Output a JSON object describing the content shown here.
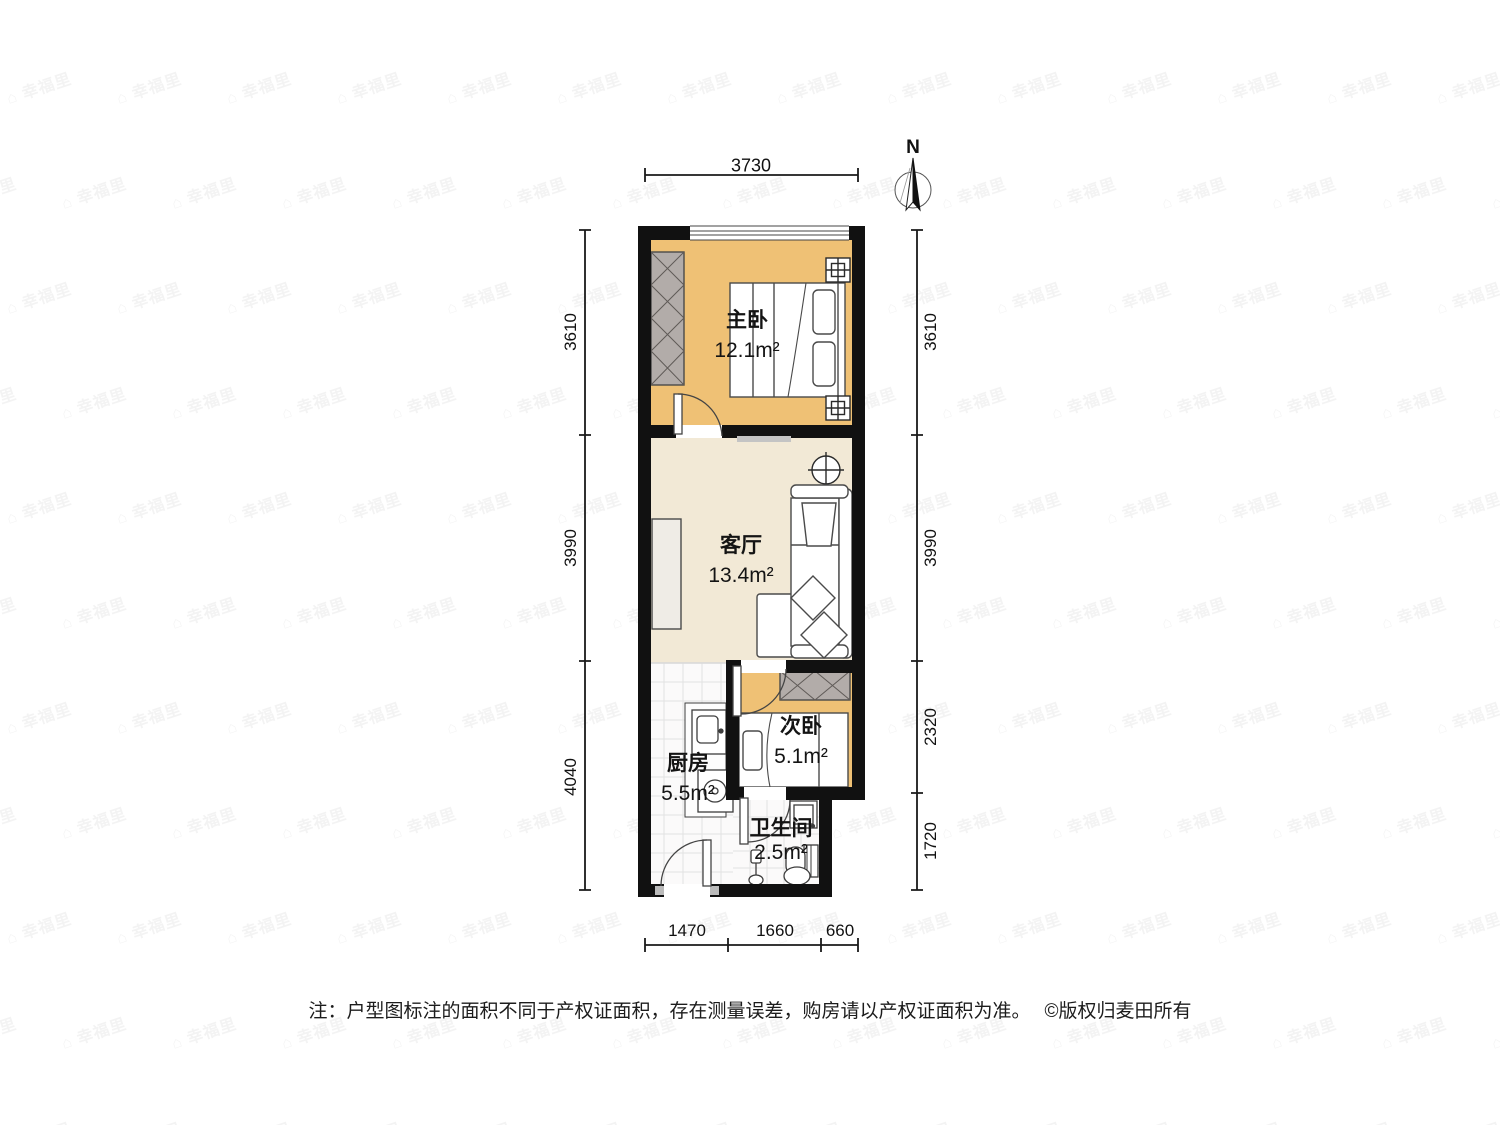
{
  "compass": {
    "label": "N"
  },
  "dimensions": {
    "top": [
      "3730"
    ],
    "left": [
      "3610",
      "3990",
      "4040"
    ],
    "right": [
      "3610",
      "3990",
      "2320",
      "1720"
    ],
    "bottom": [
      "1470",
      "1660",
      "660"
    ]
  },
  "rooms": {
    "master_bedroom": {
      "name": "主卧",
      "area": "12.1m²"
    },
    "living_room": {
      "name": "客厅",
      "area": "13.4m²"
    },
    "second_bedroom": {
      "name": "次卧",
      "area": "5.1m²"
    },
    "kitchen": {
      "name": "厨房",
      "area": "5.5m²"
    },
    "bathroom": {
      "name": "卫生间",
      "area": "2.5m²"
    }
  },
  "note": {
    "disclaimer": "注：户型图标注的面积不同于产权证面积，存在测量误差，购房请以产权证面积为准。",
    "copyright": "©版权归麦田所有"
  },
  "watermark": {
    "text": "幸福里"
  },
  "colors": {
    "wall": "#111111",
    "bedroom_floor": "#efc175",
    "living_floor": "#f2e9d6",
    "tile_floor": "#fbfafa",
    "wardrobe": "#b2aca9",
    "furniture_stroke": "#4a4a4a",
    "dimension": "#1a1a1a"
  }
}
